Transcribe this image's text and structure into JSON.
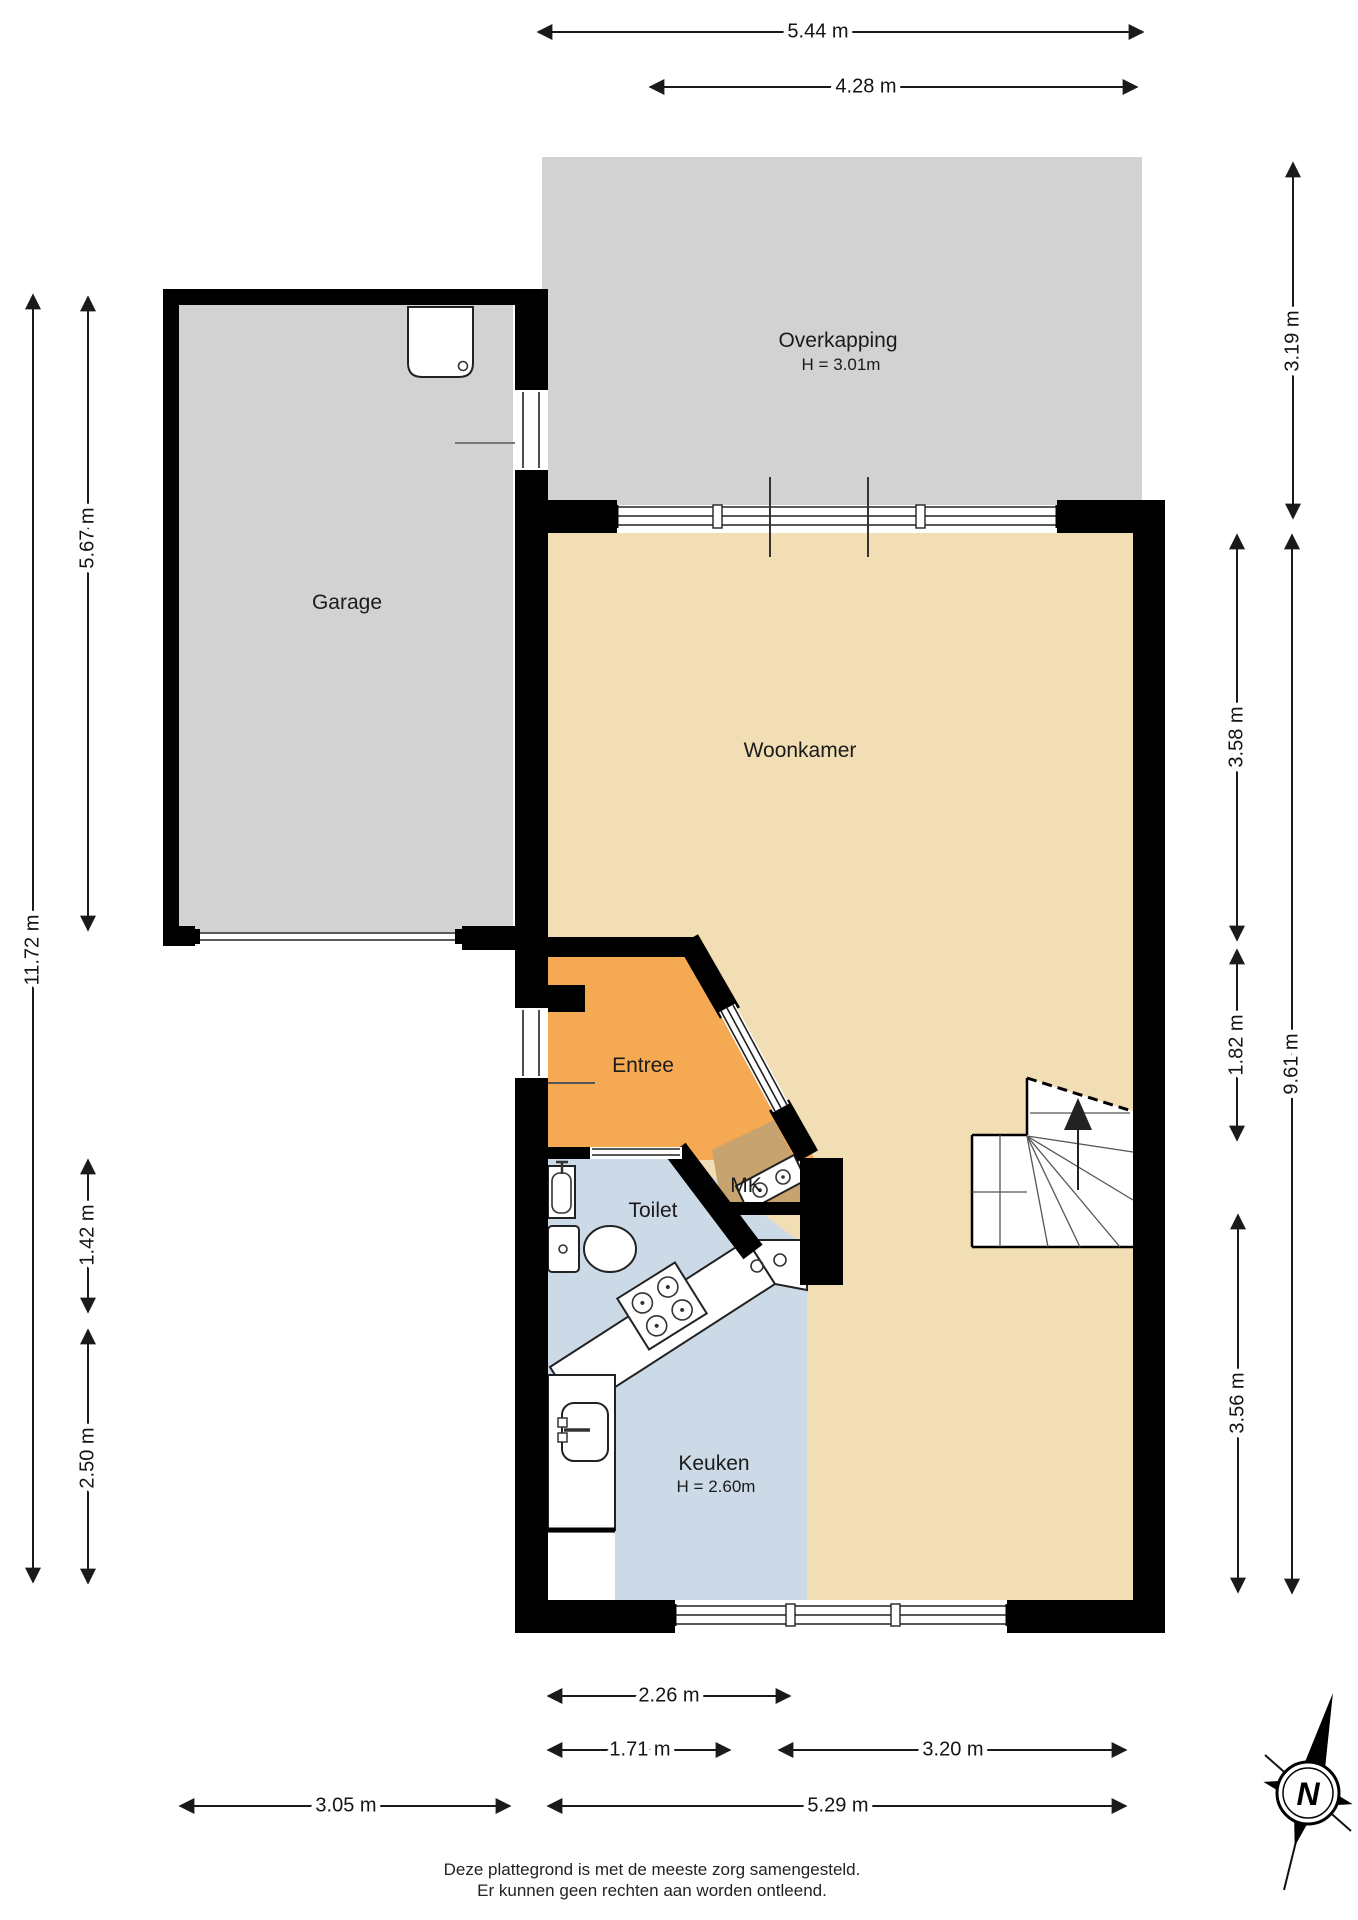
{
  "page": {
    "background": "#ffffff"
  },
  "colors": {
    "room_gray": "#d2d2d2",
    "room_beige": "#f2deb4",
    "room_orange": "#f5a952",
    "room_blue": "#ccdae7",
    "room_brown": "#c7a36f",
    "wall_black": "#000000",
    "stair_white": "#ffffff"
  },
  "rooms": {
    "overkapping": {
      "label": "Overkapping",
      "height": "H = 3.01m"
    },
    "garage": {
      "label": "Garage"
    },
    "woonkamer": {
      "label": "Woonkamer"
    },
    "entree": {
      "label": "Entree"
    },
    "toilet": {
      "label": "Toilet"
    },
    "mk": {
      "label": "MK"
    },
    "keuken": {
      "label": "Keuken",
      "height": "H = 2.60m"
    }
  },
  "dimensions": [
    {
      "name": "top-total-width",
      "label": "5.44 m",
      "x1": 538,
      "y1": 32,
      "x2": 1143,
      "y2": 32,
      "lx": 818,
      "ly": 32,
      "rot": false
    },
    {
      "name": "top-overkapping-width",
      "label": "4.28 m",
      "x1": 650,
      "y1": 87,
      "x2": 1137,
      "y2": 87,
      "lx": 866,
      "ly": 87,
      "rot": false
    },
    {
      "name": "right-overkapping-depth",
      "label": "3.19 m",
      "x1": 1293,
      "y1": 163,
      "x2": 1293,
      "y2": 518,
      "lx": 1293,
      "ly": 341,
      "rot": true
    },
    {
      "name": "right-woonkamer-depth",
      "label": "3.58 m",
      "x1": 1237,
      "y1": 535,
      "x2": 1237,
      "y2": 940,
      "lx": 1237,
      "ly": 737,
      "rot": true
    },
    {
      "name": "right-entree-depth",
      "label": "1.82 m",
      "x1": 1237,
      "y1": 950,
      "x2": 1237,
      "y2": 1140,
      "lx": 1237,
      "ly": 1045,
      "rot": true
    },
    {
      "name": "right-keuken-depth",
      "label": "3.56 m",
      "x1": 1238,
      "y1": 1215,
      "x2": 1238,
      "y2": 1592,
      "lx": 1238,
      "ly": 1403,
      "rot": true
    },
    {
      "name": "right-house-depth",
      "label": "9.61 m",
      "x1": 1292,
      "y1": 535,
      "x2": 1292,
      "y2": 1593,
      "lx": 1292,
      "ly": 1064,
      "rot": true
    },
    {
      "name": "left-total-depth",
      "label": "11.72 m",
      "x1": 33,
      "y1": 295,
      "x2": 33,
      "y2": 1582,
      "lx": 33,
      "ly": 950,
      "rot": true
    },
    {
      "name": "left-garage-depth",
      "label": "5.67 m",
      "x1": 88,
      "y1": 297,
      "x2": 88,
      "y2": 930,
      "lx": 88,
      "ly": 538,
      "rot": true
    },
    {
      "name": "left-toilet-depth",
      "label": "1.42 m",
      "x1": 88,
      "y1": 1160,
      "x2": 88,
      "y2": 1312,
      "lx": 88,
      "ly": 1235,
      "rot": true
    },
    {
      "name": "left-keuken-depth",
      "label": "2.50 m",
      "x1": 88,
      "y1": 1330,
      "x2": 88,
      "y2": 1583,
      "lx": 88,
      "ly": 1458,
      "rot": true
    },
    {
      "name": "bottom-keuken-width",
      "label": "2.26 m",
      "x1": 548,
      "y1": 1696,
      "x2": 790,
      "y2": 1696,
      "lx": 669,
      "ly": 1696,
      "rot": false
    },
    {
      "name": "bottom-keuken-inner-width",
      "label": "1.71 m",
      "x1": 548,
      "y1": 1750,
      "x2": 730,
      "y2": 1750,
      "lx": 640,
      "ly": 1750,
      "rot": false
    },
    {
      "name": "bottom-woonkamer-width",
      "label": "3.20 m",
      "x1": 779,
      "y1": 1750,
      "x2": 1126,
      "y2": 1750,
      "lx": 953,
      "ly": 1750,
      "rot": false
    },
    {
      "name": "bottom-garage-width",
      "label": "3.05 m",
      "x1": 180,
      "y1": 1806,
      "x2": 510,
      "y2": 1806,
      "lx": 346,
      "ly": 1806,
      "rot": false
    },
    {
      "name": "bottom-house-width",
      "label": "5.29 m",
      "x1": 548,
      "y1": 1806,
      "x2": 1126,
      "y2": 1806,
      "lx": 838,
      "ly": 1806,
      "rot": false
    }
  ],
  "footer": {
    "line1": "Deze plattegrond is met de meeste zorg samengesteld.",
    "line2": "Er kunnen geen rechten aan worden ontleend."
  },
  "compass": {
    "north_label": "N"
  }
}
